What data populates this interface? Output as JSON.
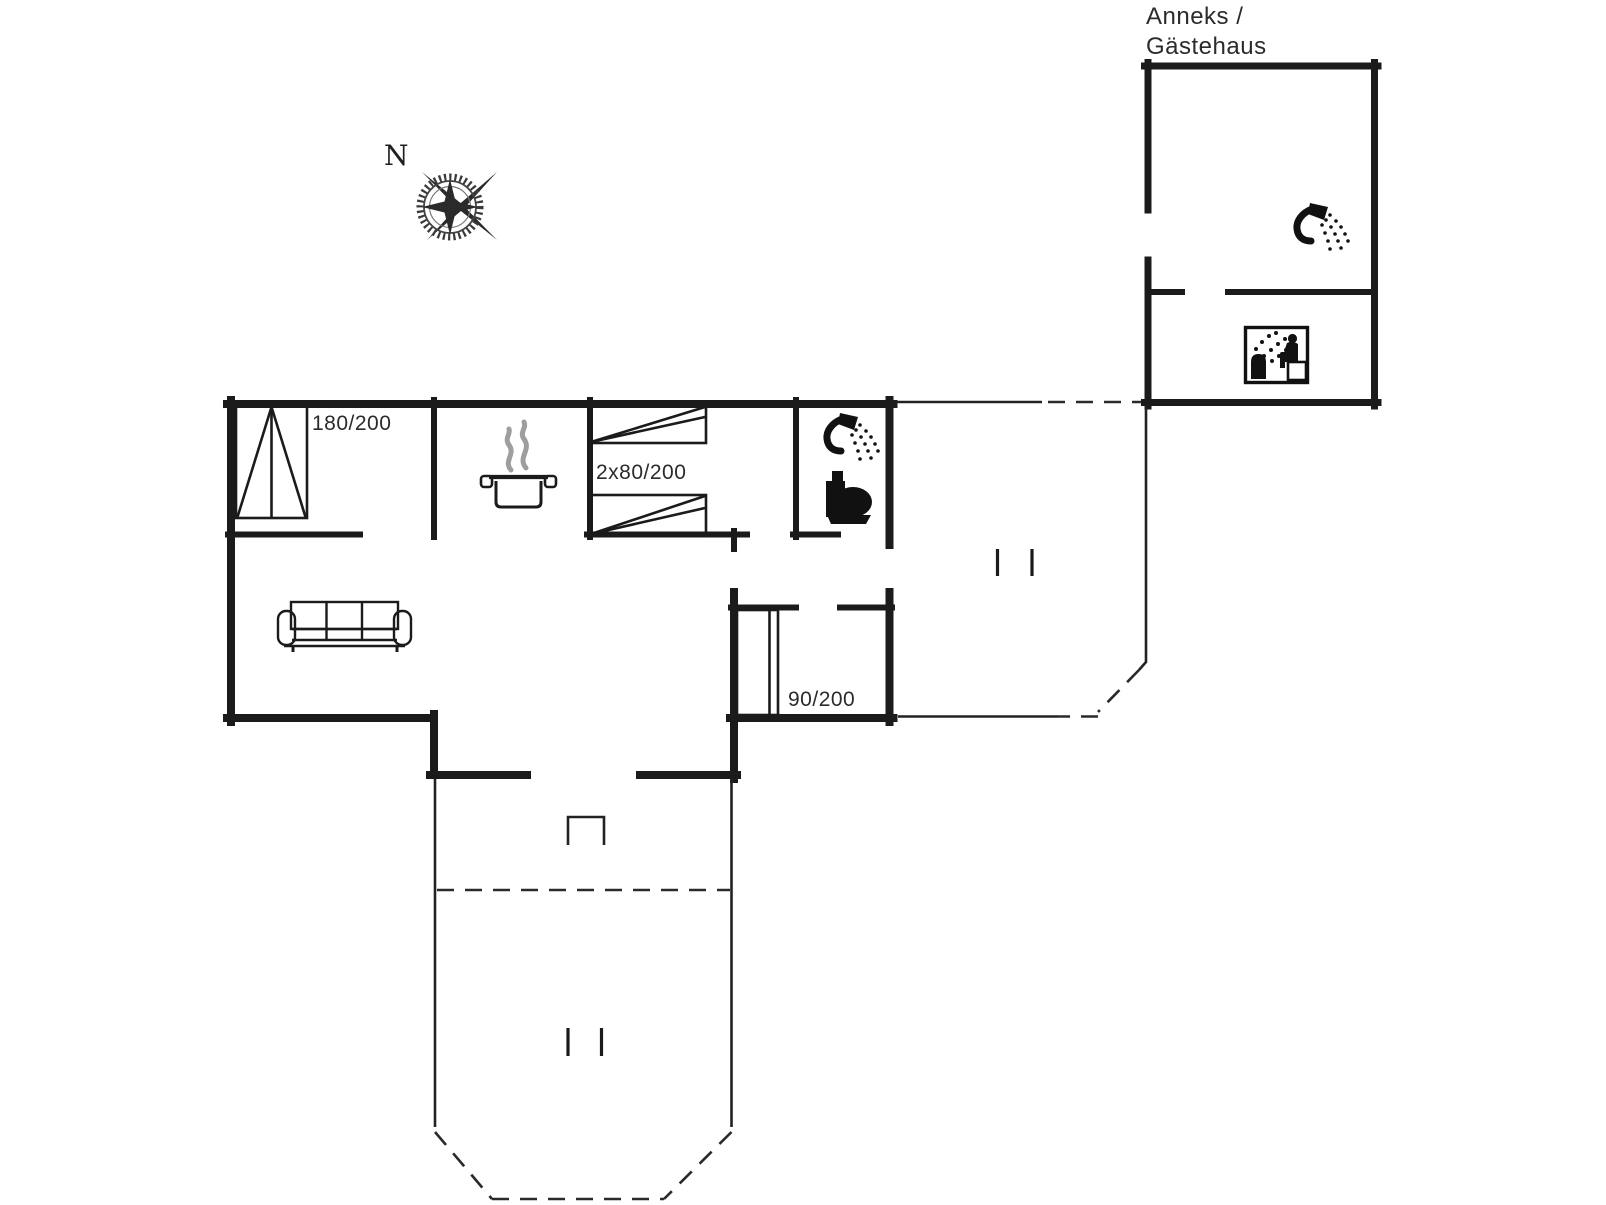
{
  "plan": {
    "annex_label_line1": "Anneks /",
    "annex_label_line2": "Gästehaus",
    "compass_north": "N",
    "bed_sizes": {
      "double": "180/200",
      "twin": "2x80/200",
      "single": "90/200"
    },
    "icons": [
      "compass-rose",
      "double-bed",
      "twin-beds",
      "single-bed",
      "sofa",
      "cooking-pot",
      "shower",
      "toilet",
      "sauna",
      "entrance-step"
    ],
    "colors": {
      "line": "#1b1b1b",
      "background": "#ffffff",
      "steam_gray": "#9e9e9e",
      "text": "#2b2b2b"
    }
  }
}
